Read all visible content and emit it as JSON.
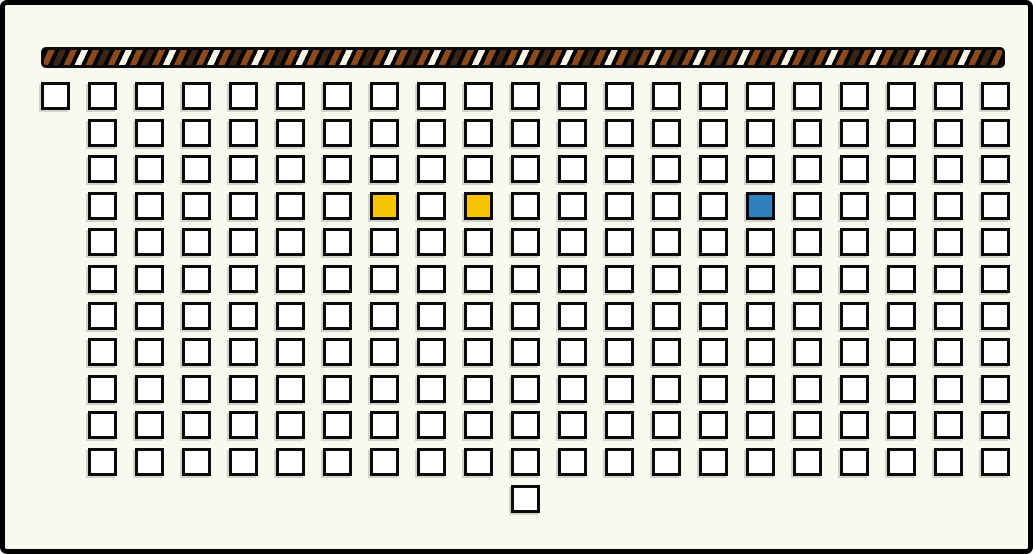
{
  "canvas": {
    "width": 1033,
    "height": 554,
    "background_color": "#FAF9F0",
    "frame_color": "#000000",
    "frame_thickness": 5
  },
  "hatched_bar": {
    "x": 36,
    "y": 42,
    "width": 964,
    "height": 21,
    "base_color": "#000000",
    "stripe_colors": {
      "rust": "#8B4A1E",
      "dark_brown": "#3A2517",
      "white": "#F7F4EA"
    },
    "stripe_direction": "diagonal-top-right"
  },
  "grid": {
    "origin_x": 36,
    "origin_y": 77,
    "col_spacing": 47,
    "row_spacing": 36.6,
    "cell_width": 29,
    "cell_height": 28,
    "cell_fill": "#FFFFFF",
    "cell_border_color": "#0A0A0A",
    "total_columns": 21,
    "total_rows": 11,
    "row_layout": [
      {
        "row": 0,
        "first_col": 0,
        "last_col": 20,
        "count": 21
      },
      {
        "row": 1,
        "first_col": 1,
        "last_col": 20,
        "count": 20
      },
      {
        "row": 2,
        "first_col": 1,
        "last_col": 20,
        "count": 20
      },
      {
        "row": 3,
        "first_col": 1,
        "last_col": 20,
        "count": 20
      },
      {
        "row": 4,
        "first_col": 1,
        "last_col": 20,
        "count": 20
      },
      {
        "row": 5,
        "first_col": 1,
        "last_col": 20,
        "count": 20
      },
      {
        "row": 6,
        "first_col": 1,
        "last_col": 20,
        "count": 20
      },
      {
        "row": 7,
        "first_col": 1,
        "last_col": 20,
        "count": 20
      },
      {
        "row": 8,
        "first_col": 1,
        "last_col": 20,
        "count": 20
      },
      {
        "row": 9,
        "first_col": 1,
        "last_col": 20,
        "count": 20
      },
      {
        "row": 10,
        "first_col": 1,
        "last_col": 20,
        "count": 20
      }
    ],
    "below_grid_cell": {
      "row": 11,
      "col": 10
    },
    "total_cells": 222,
    "highlighted_cells": [
      {
        "row": 3,
        "col": 7,
        "color": "#F6C402",
        "name": "yellow-highlight-cell-1"
      },
      {
        "row": 3,
        "col": 9,
        "color": "#F6C402",
        "name": "yellow-highlight-cell-2"
      },
      {
        "row": 3,
        "col": 15,
        "color": "#2F80BD",
        "name": "blue-highlight-cell"
      }
    ]
  }
}
